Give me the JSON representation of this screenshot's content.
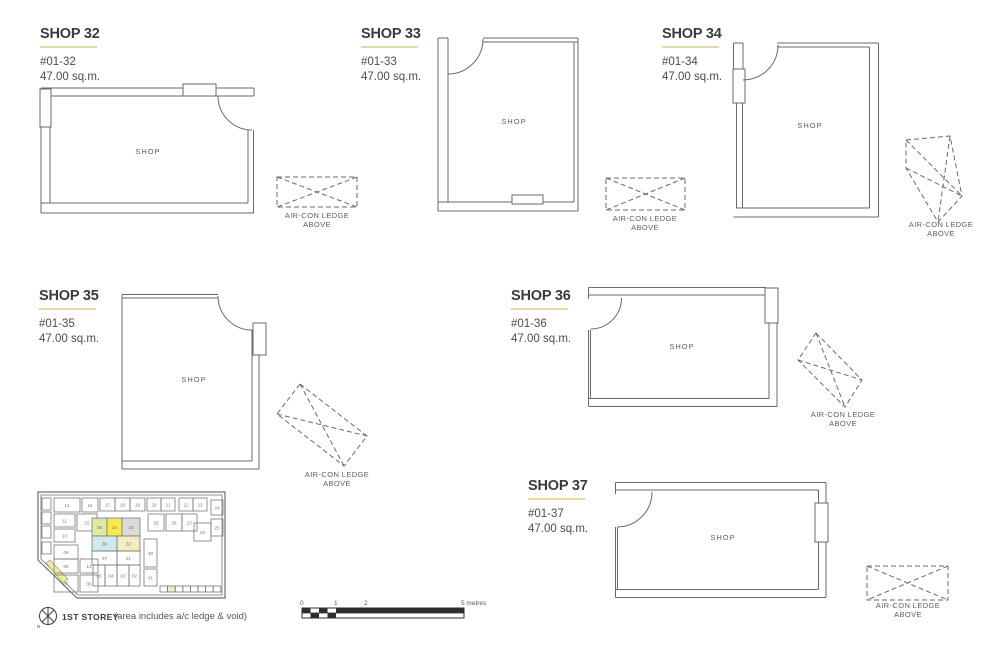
{
  "units": [
    {
      "title": "SHOP 32",
      "unit_no": "#01-32",
      "area": "47.00 sq.m.",
      "room_label": "SHOP"
    },
    {
      "title": "SHOP 33",
      "unit_no": "#01-33",
      "area": "47.00 sq.m.",
      "room_label": "SHOP"
    },
    {
      "title": "SHOP 34",
      "unit_no": "#01-34",
      "area": "47.00 sq.m.",
      "room_label": "SHOP"
    },
    {
      "title": "SHOP 35",
      "unit_no": "#01-35",
      "area": "47.00 sq.m.",
      "room_label": "SHOP"
    },
    {
      "title": "SHOP 36",
      "unit_no": "#01-36",
      "area": "47.00 sq.m.",
      "room_label": "SHOP"
    },
    {
      "title": "SHOP 37",
      "unit_no": "#01-37",
      "area": "47.00 sq.m.",
      "room_label": "SHOP"
    }
  ],
  "aircon": {
    "line1": "AIR-CON  LEDGE",
    "line2": "ABOVE"
  },
  "legend": {
    "storey": "1ST STOREY",
    "note": "(area includes a/c ledge & void)",
    "north": "N"
  },
  "scale_bar": {
    "ticks": [
      {
        "label": "0"
      },
      {
        "label": "1"
      },
      {
        "label": "2"
      },
      {
        "label": "5 metres"
      }
    ]
  },
  "colors": {
    "accent_underline": "#ead6a0",
    "plan_line": "#6a6a6a",
    "highlight_34": "#f5ec4c",
    "highlight_35": "#dde9a5",
    "highlight_33": "#dbdbdb",
    "highlight_36": "#cfe9ee",
    "highlight_32": "#f4edc4",
    "keyplan_number": "#9c6f4c"
  },
  "keyplan": {
    "cells": [
      {
        "l": "",
        "x": 17,
        "y": 15,
        "w": 9,
        "h": 12
      },
      {
        "l": "",
        "x": 17,
        "y": 29,
        "w": 9,
        "h": 12
      },
      {
        "l": "",
        "x": 17,
        "y": 43,
        "w": 9,
        "h": 12
      },
      {
        "l": "",
        "x": 17,
        "y": 59,
        "w": 9,
        "h": 12
      },
      {
        "l": "12",
        "x": 29,
        "y": 15,
        "w": 26,
        "h": 14
      },
      {
        "l": "16",
        "x": 57,
        "y": 15,
        "w": 16,
        "h": 14
      },
      {
        "l": "17",
        "x": 75,
        "y": 15,
        "w": 15,
        "h": 13
      },
      {
        "l": "18",
        "x": 90,
        "y": 15,
        "w": 15,
        "h": 13
      },
      {
        "l": "19",
        "x": 105,
        "y": 15,
        "w": 15,
        "h": 13
      },
      {
        "l": "20",
        "x": 122,
        "y": 15,
        "w": 14,
        "h": 13
      },
      {
        "l": "21",
        "x": 136,
        "y": 15,
        "w": 14,
        "h": 13
      },
      {
        "l": "22",
        "x": 154,
        "y": 15,
        "w": 14,
        "h": 13
      },
      {
        "l": "23",
        "x": 168,
        "y": 15,
        "w": 14,
        "h": 13
      },
      {
        "l": "24",
        "x": 186,
        "y": 17,
        "w": 12,
        "h": 15
      },
      {
        "l": "25",
        "x": 186,
        "y": 36,
        "w": 12,
        "h": 17
      },
      {
        "l": "11",
        "x": 29,
        "y": 31,
        "w": 21,
        "h": 13
      },
      {
        "l": "15",
        "x": 52,
        "y": 31,
        "w": 20,
        "h": 17
      },
      {
        "l": "10",
        "x": 29,
        "y": 46,
        "w": 21,
        "h": 13
      },
      {
        "l": "09",
        "x": 29,
        "y": 62,
        "w": 24,
        "h": 14
      },
      {
        "l": "08",
        "x": 29,
        "y": 76,
        "w": 24,
        "h": 14
      },
      {
        "l": "13",
        "x": 55,
        "y": 76,
        "w": 18,
        "h": 14
      },
      {
        "l": "07",
        "x": 29,
        "y": 92,
        "w": 24,
        "h": 17
      },
      {
        "l": "06",
        "x": 55,
        "y": 92,
        "w": 18,
        "h": 17
      },
      {
        "l": "35",
        "x": 67,
        "y": 35,
        "w": 15,
        "h": 18,
        "f": "#dde9a5"
      },
      {
        "l": "34",
        "x": 82,
        "y": 35,
        "w": 15,
        "h": 18,
        "f": "#f5ec4c"
      },
      {
        "l": "33",
        "x": 97,
        "y": 35,
        "w": 18,
        "h": 18,
        "f": "#dbdbdb"
      },
      {
        "l": "36",
        "x": 67,
        "y": 53,
        "w": 25,
        "h": 15,
        "f": "#cfe9ee"
      },
      {
        "l": "32",
        "x": 92,
        "y": 53,
        "w": 23,
        "h": 15,
        "f": "#f4edc4"
      },
      {
        "l": "37",
        "x": 67,
        "y": 68,
        "w": 25,
        "h": 14
      },
      {
        "l": "31",
        "x": 92,
        "y": 68,
        "w": 23,
        "h": 14
      },
      {
        "l": "05",
        "x": 68,
        "y": 82,
        "w": 12,
        "h": 21
      },
      {
        "l": "04",
        "x": 80,
        "y": 82,
        "w": 12,
        "h": 21
      },
      {
        "l": "03",
        "x": 92,
        "y": 82,
        "w": 12,
        "h": 21
      },
      {
        "l": "02",
        "x": 104,
        "y": 82,
        "w": 11,
        "h": 21
      },
      {
        "l": "29",
        "x": 123,
        "y": 31,
        "w": 16,
        "h": 17
      },
      {
        "l": "28",
        "x": 141,
        "y": 31,
        "w": 16,
        "h": 17
      },
      {
        "l": "27",
        "x": 157,
        "y": 31,
        "w": 15,
        "h": 17
      },
      {
        "l": "26",
        "x": 169,
        "y": 40,
        "w": 17,
        "h": 18
      },
      {
        "l": "30",
        "x": 119,
        "y": 56,
        "w": 13,
        "h": 28
      },
      {
        "l": "01",
        "x": 119,
        "y": 86,
        "w": 13,
        "h": 17
      },
      {
        "l": "",
        "x": 135,
        "y": 103,
        "w": 7.6,
        "h": 6
      },
      {
        "l": "",
        "x": 142.6,
        "y": 103,
        "w": 7.6,
        "h": 6,
        "f": "#f4edc4"
      },
      {
        "l": "",
        "x": 150.2,
        "y": 103,
        "w": 7.6,
        "h": 6
      },
      {
        "l": "",
        "x": 157.8,
        "y": 103,
        "w": 7.6,
        "h": 6
      },
      {
        "l": "",
        "x": 165.4,
        "y": 103,
        "w": 7.6,
        "h": 6
      },
      {
        "l": "",
        "x": 173,
        "y": 103,
        "w": 7.6,
        "h": 6
      },
      {
        "l": "",
        "x": 180.6,
        "y": 103,
        "w": 7.6,
        "h": 6
      },
      {
        "l": "",
        "x": 188.2,
        "y": 103,
        "w": 7.6,
        "h": 6
      }
    ]
  }
}
